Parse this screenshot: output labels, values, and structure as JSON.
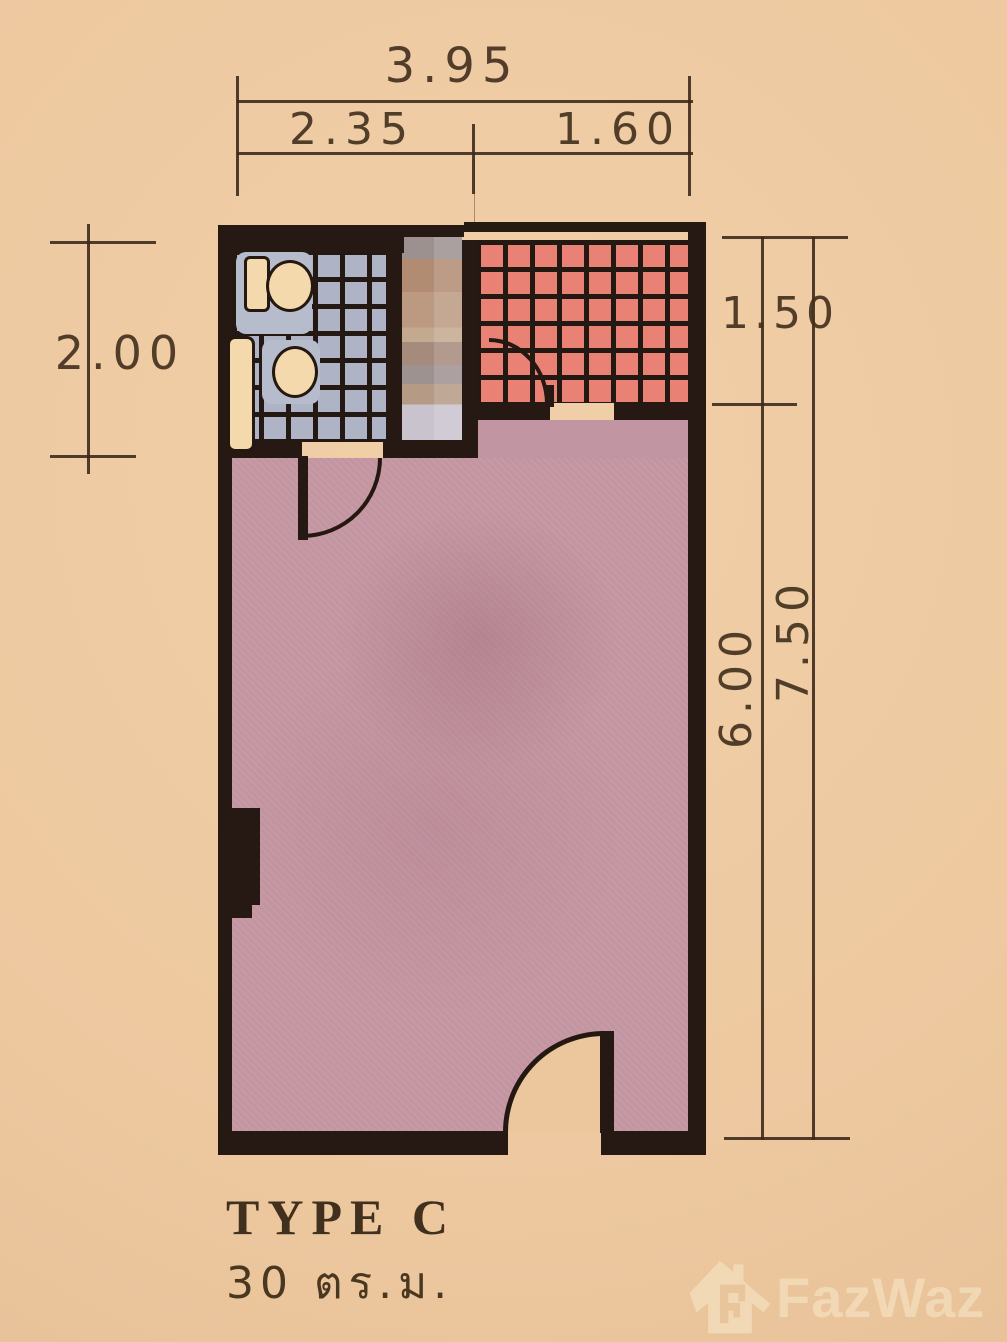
{
  "title": {
    "type_label": "TYPE C",
    "area_label": "30 ตร.ม."
  },
  "dimensions": {
    "top_total": "3.95",
    "top_left_segment": "2.35",
    "top_right_segment": "1.60",
    "left_side": "2.00",
    "right_top_segment": "1.50",
    "right_main_segment": "6.00",
    "right_total": "7.50"
  },
  "watermark": {
    "brand": "FazWaz",
    "icon": "house-logo-icon"
  },
  "fixtures": [
    "toilet-fixture",
    "sink-fixture",
    "counter-fixture",
    "blurred-area"
  ],
  "colors": {
    "background": "#edc89f",
    "walls": "#261812",
    "bathroom_tile": "#aeb3c5",
    "tiled_area_red": "#e98275",
    "room_fill": "#c395a1",
    "fixture_cream": "#f3d9ab",
    "dimension_text": "#44321f",
    "watermark_cream": "#f4debc"
  }
}
